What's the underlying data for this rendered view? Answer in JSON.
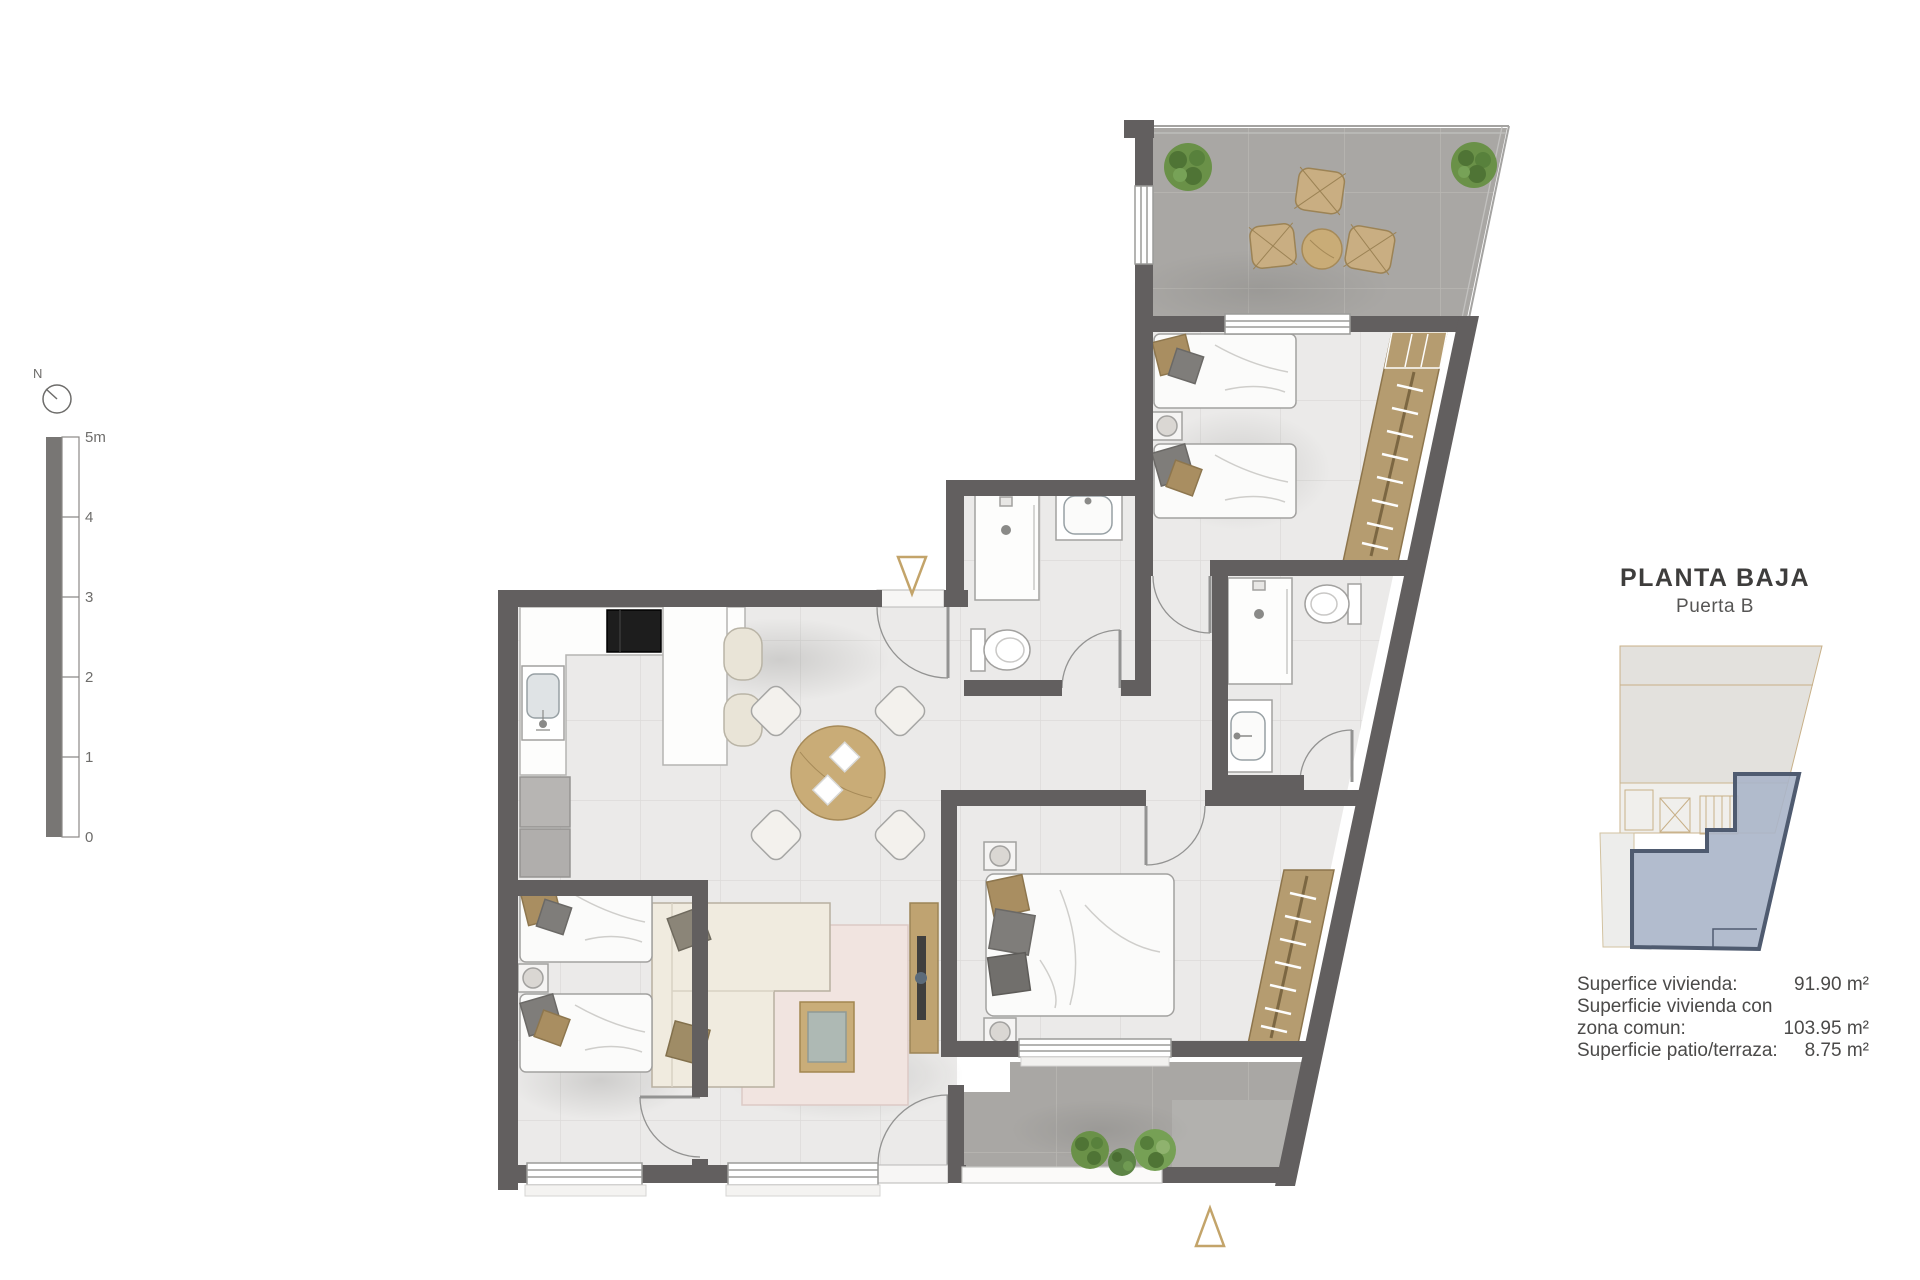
{
  "title_block": {
    "title": "PLANTA BAJA",
    "subtitle": "Puerta B"
  },
  "legend": {
    "rows": [
      {
        "label": "Superfice vivienda:",
        "value": "91.90 m²"
      },
      {
        "label": "Superficie vivienda con",
        "value": ""
      },
      {
        "label": "zona comun:",
        "value": "103.95 m²"
      },
      {
        "label": "Superficie patio/terraza:",
        "value": "8.75 m²"
      }
    ]
  },
  "scale_bar": {
    "unit_labels": [
      "5m",
      "4",
      "3",
      "2",
      "1",
      "0"
    ]
  },
  "compass": {
    "label": "N"
  },
  "colors": {
    "wall": "#625f5f",
    "interior_floor": "#ebeae9",
    "terrace_floor": "#a9a7a4",
    "closet_wood": "#b59c70",
    "table_wood": "#c9ac77",
    "entry_marker": "#c3a46a",
    "keyplan_highlight_fill": "#aab5c9",
    "keyplan_highlight_stroke": "#4f5b70",
    "plant_green": "#6a9148"
  }
}
